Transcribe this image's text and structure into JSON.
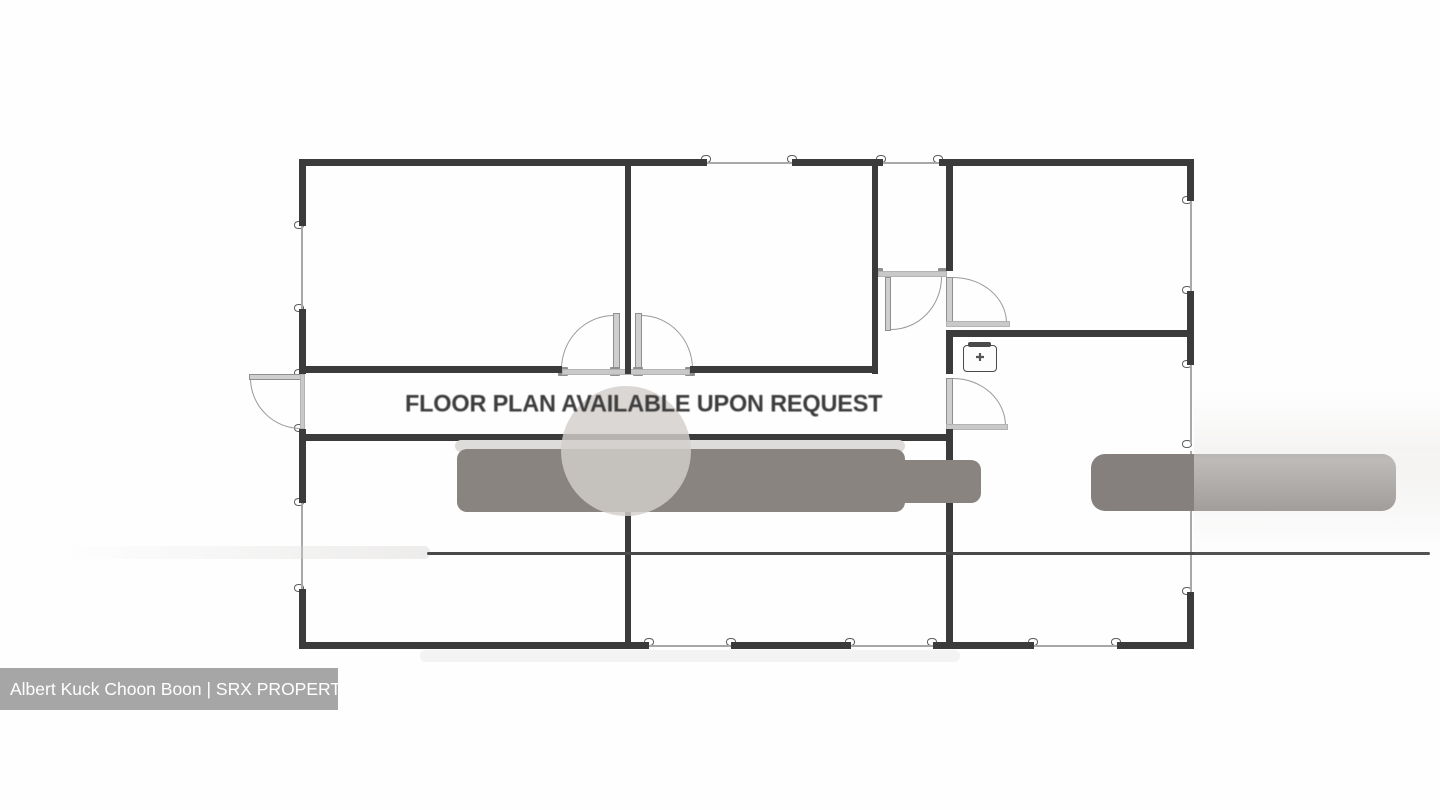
{
  "watermark": {
    "text": "FLOOR PLAN AVAILABLE UPON REQUEST"
  },
  "caption": {
    "agent": "Albert Kuck Choon Boon",
    "brand": "SRX PROPERTY",
    "text": "Albert Kuck Choon Boon | SRX PROPERTY"
  },
  "icons": {
    "aircon_glyph": "✚"
  },
  "colors": {
    "wall": "#3b3b3b",
    "window_line": "#a8a8a8",
    "door_leaf": "#cfcfcf",
    "blur_bar": "#8a8480",
    "blur_bar_right": "#85807d",
    "caption_bg": "#a6a6a6",
    "caption_text": "#ffffff",
    "watermark_text": "#3d3d3d"
  }
}
